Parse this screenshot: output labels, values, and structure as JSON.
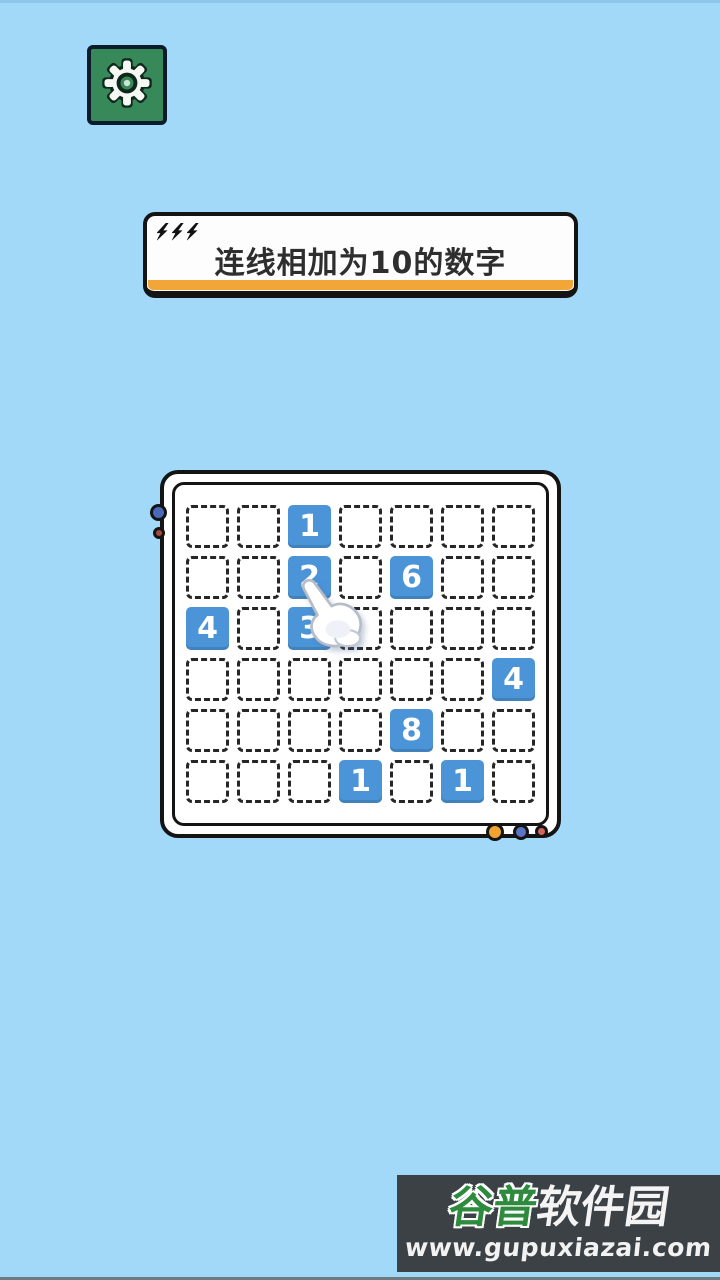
{
  "app": {
    "background_color": "#a2d8f8"
  },
  "settings_button": {
    "icon": "gear-icon",
    "bg_color": "#37895a",
    "border_color": "#0d1c2b"
  },
  "banner": {
    "title": "连线相加为10的数字",
    "accent_color": "#f2a637",
    "bolt_icon": "lightning-bolt-icon",
    "bolt_count": 3
  },
  "board": {
    "columns": 7,
    "rows": 6,
    "tile_color": "#4b94d8",
    "tiles": [
      {
        "row": 0,
        "col": 2,
        "value": "1"
      },
      {
        "row": 1,
        "col": 2,
        "value": "2"
      },
      {
        "row": 1,
        "col": 4,
        "value": "6"
      },
      {
        "row": 2,
        "col": 0,
        "value": "4"
      },
      {
        "row": 2,
        "col": 2,
        "value": "3"
      },
      {
        "row": 3,
        "col": 6,
        "value": "4"
      },
      {
        "row": 4,
        "col": 4,
        "value": "8"
      },
      {
        "row": 5,
        "col": 3,
        "value": "1"
      },
      {
        "row": 5,
        "col": 5,
        "value": "1"
      }
    ],
    "decor_dots": {
      "left_blue": "#4c68b8",
      "left_red": "#a34a42",
      "bottom_orange": "#f0a331",
      "bottom_blue": "#5b74c4",
      "bottom_red": "#d4635c"
    }
  },
  "cursor": {
    "icon": "pointing-hand-cursor"
  },
  "watermark": {
    "brand_green": "谷普",
    "brand_white": "软件园",
    "url": "www.gupuxiazai.com",
    "bg_color": "#3b4145",
    "green_color": "#2e8b3d"
  }
}
